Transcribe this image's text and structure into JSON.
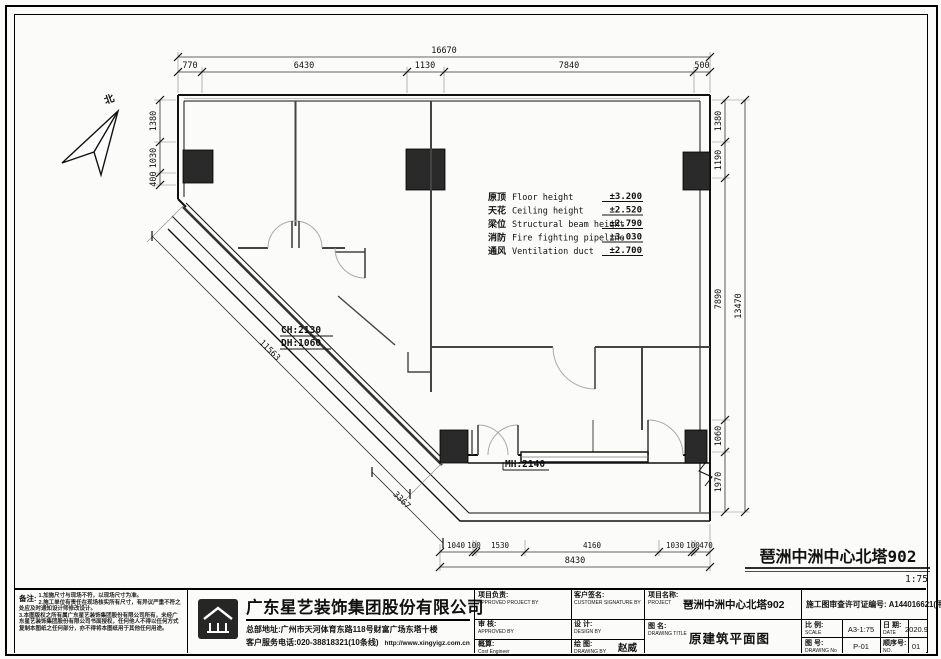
{
  "drawing": {
    "north_label": "北",
    "plan_title": "琶洲中洲中心北塔902",
    "plan_scale": "1:75",
    "labels": {
      "ch": "CH:2130",
      "dh": "DH:1060",
      "mh": "MH:2140"
    },
    "heights": [
      {
        "cn": "原顶",
        "en": "Floor height",
        "val": "±3.200"
      },
      {
        "cn": "天花",
        "en": "Ceiling height",
        "val": "±2.520"
      },
      {
        "cn": "梁位",
        "en": "Structural beam height",
        "val": "±2.790"
      },
      {
        "cn": "消防",
        "en": "Fire fighting pipeline",
        "val": "±3.030"
      },
      {
        "cn": "通风",
        "en": "Ventilation duct",
        "val": "±2.700"
      }
    ],
    "dims": {
      "top_total": "16670",
      "top": [
        "770",
        "6430",
        "1130",
        "7840",
        "500"
      ],
      "right": [
        "1380",
        "1190",
        "7890",
        "1060",
        "1970"
      ],
      "right_total": "13470",
      "left": [
        "1380",
        "1030",
        "400"
      ],
      "diagonal": "11563",
      "diagonal2": "3367",
      "bottom": [
        "1040",
        "100",
        "1530",
        "4160",
        "1030",
        "100",
        "470"
      ],
      "bottom_total": "8430"
    }
  },
  "titleblock": {
    "notes": {
      "label": "备注:",
      "line1": "1.加施尺寸与现场不符，以现场尺寸为准。",
      "line2": "2.施工单位有责任在现场核实所有尺寸，有异议严重不符之处应及时通知设计师修改设计。",
      "line3": "3.本图版权之所有属广东星艺装饰集团股份有限公司所有，未经广东星艺装饰集团股份有限公司书面授权，任何他人不得以任何方式复制本图纸之任何部分，亦不得将本图纸用于其他任何用途。"
    },
    "company": {
      "name": "广东星艺装饰集团股份有限公司",
      "address": "总部地址:广州市天河体育东路118号财富广场东塔十楼",
      "phone": "客户服务电话:020-38818321(10条线)",
      "website": "http://www.xingyigz.com.cn"
    },
    "sign": {
      "approved_project": {
        "cn": "项目负责:",
        "en": "APPROVED PROJECT BY"
      },
      "customer": {
        "cn": "客户签名:",
        "en": "CUSTOMER SIGNATURE BY"
      },
      "approved": {
        "cn": "审 核:",
        "en": "APPROVED BY"
      },
      "design": {
        "cn": "设 计:",
        "en": "DESIGN BY"
      },
      "cost": {
        "cn": "概算:",
        "en": "Cost Engineer"
      },
      "drawing_by": {
        "cn": "绘 图:",
        "en": "DRAWING BY",
        "value": "赵威"
      }
    },
    "project": {
      "label_cn": "项目名称:",
      "label_en": "PROJECT",
      "value": "琶洲中洲中心北塔902",
      "title_cn": "图 名:",
      "title_en": "DRAWING TITLE",
      "title_value": "原建筑平面图"
    },
    "permit": {
      "license": "施工图审查许可证编号: A144016621(甲级)",
      "scale_cn": "比 例:",
      "scale_en": "SCALE",
      "scale_val": "A3-1:75",
      "date_cn": "日 期:",
      "date_en": "DATE",
      "date_val": "2020.9",
      "no_cn": "图 号:",
      "no_en": "DRAWING No",
      "no_val": "P-01",
      "seq_cn": "顺序号:",
      "seq_en": "NO.",
      "seq_val": "01"
    }
  }
}
